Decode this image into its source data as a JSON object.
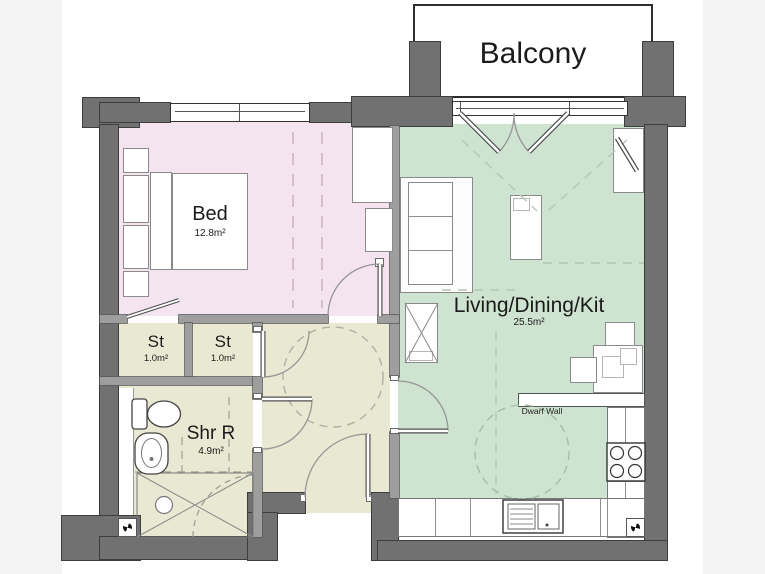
{
  "floorplan": {
    "title": "Apartment floor plan",
    "balcony": {
      "label": "Balcony"
    },
    "rooms": [
      {
        "id": "bedroom",
        "label": "Bed",
        "area": "12.8m²",
        "color": "#f3e4f0"
      },
      {
        "id": "living",
        "label": "Living/Dining/Kit",
        "area": "25.5m²",
        "color": "#cfe3d1"
      },
      {
        "id": "store-1",
        "label": "St",
        "area": "1.0m²",
        "color": "#e9e8d2"
      },
      {
        "id": "store-2",
        "label": "St",
        "area": "1.0m²",
        "color": "#e9e8d2"
      },
      {
        "id": "shower-room",
        "label": "Shr R",
        "area": "4.9m²",
        "color": "#e9e8d2"
      },
      {
        "id": "hall",
        "label": "",
        "area": "",
        "color": "#e9e8d2"
      }
    ],
    "annotations": {
      "dwarf_wall": "Dwarf Wall"
    },
    "icons": {
      "extractor_fan": "quad-pinwheel"
    },
    "colors": {
      "wall": "#717171",
      "partition": "#9e9e9e",
      "background_bars": "#f4f4f4",
      "paper": "#ffffff"
    }
  }
}
